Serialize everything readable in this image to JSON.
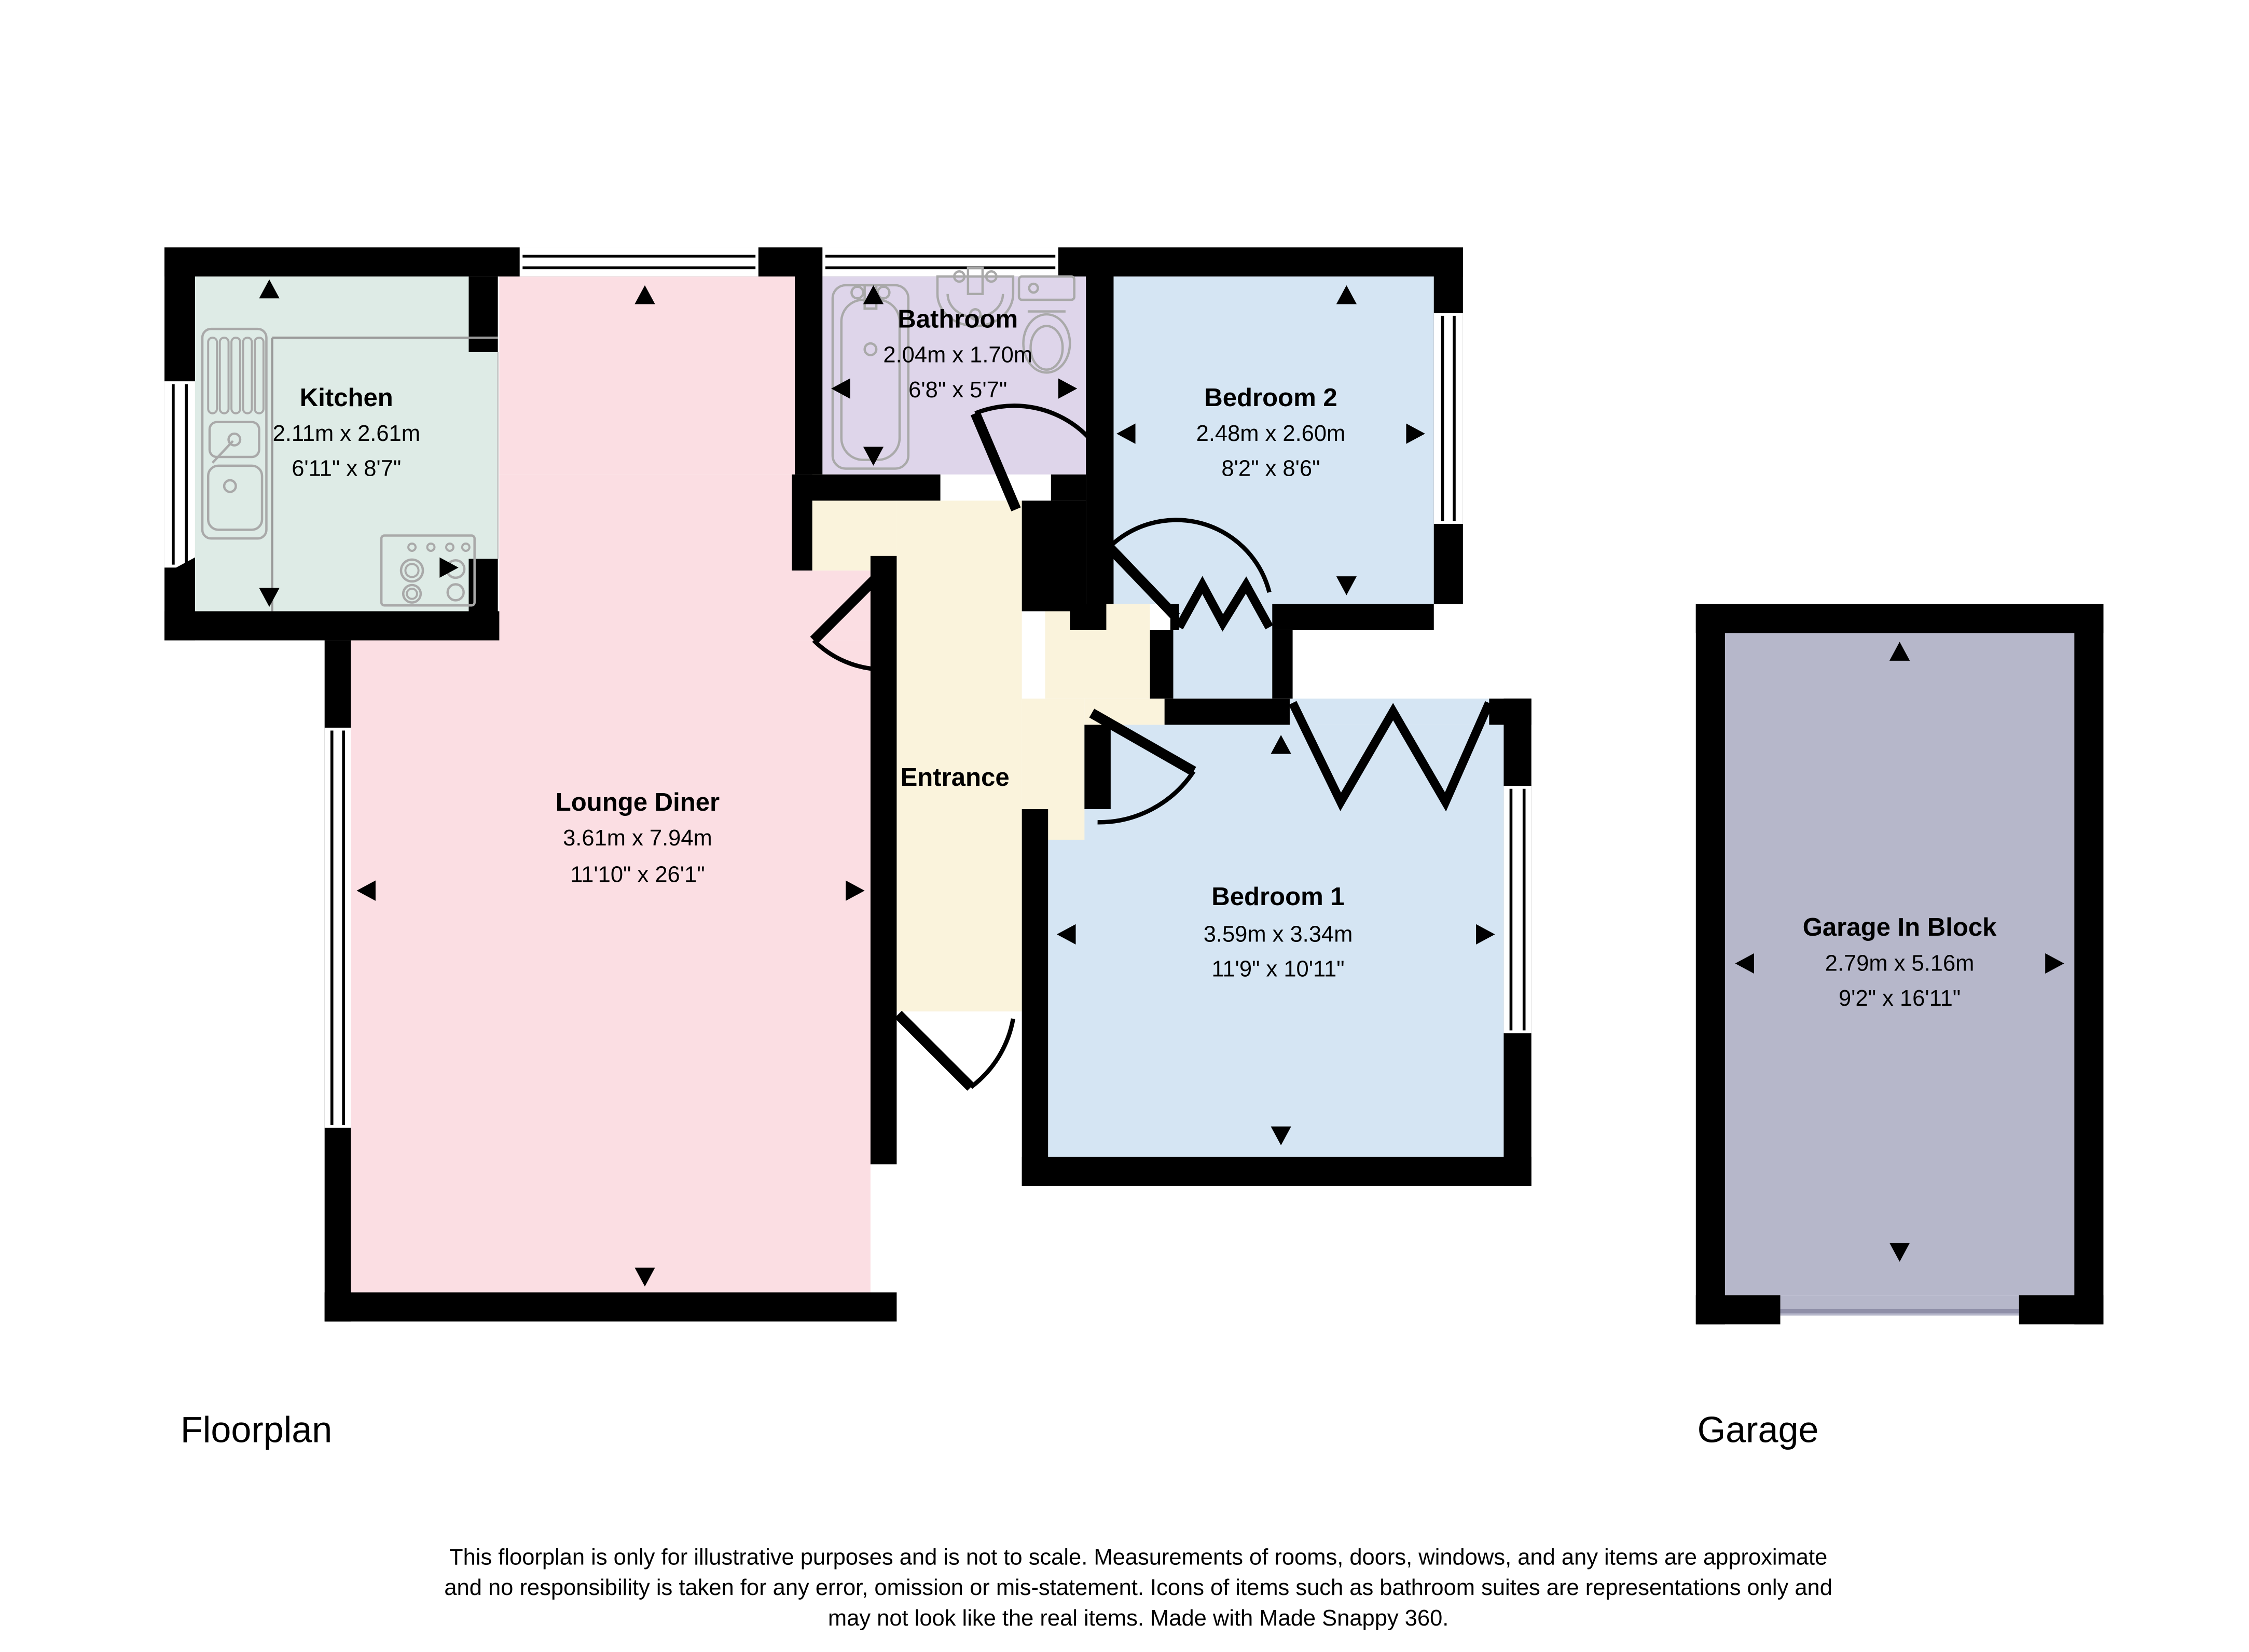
{
  "page": {
    "background": "#ffffff",
    "wall_color": "#000000"
  },
  "rooms": {
    "kitchen": {
      "name": "Kitchen",
      "metric": "2.11m x 2.61m",
      "imperial": "6'11\" x 8'7\"",
      "color": "#deebe6"
    },
    "lounge": {
      "name": "Lounge Diner",
      "metric": "3.61m x 7.94m",
      "imperial": "11'10\" x 26'1\"",
      "color": "#fbdee3"
    },
    "bathroom": {
      "name": "Bathroom",
      "metric": "2.04m x 1.70m",
      "imperial": "6'8\" x 5'7\"",
      "color": "#ded5ea"
    },
    "bedroom2": {
      "name": "Bedroom 2",
      "metric": "2.48m x 2.60m",
      "imperial": "8'2\" x 8'6\"",
      "color": "#d5e5f3"
    },
    "bedroom1": {
      "name": "Bedroom 1",
      "metric": "3.59m x 3.34m",
      "imperial": "11'9\" x 10'11\"",
      "color": "#d5e5f3"
    },
    "entrance": {
      "name": "Entrance",
      "color": "#faf3dc"
    },
    "garage": {
      "name": "Garage In Block",
      "metric": "2.79m x 5.16m",
      "imperial": "9'2\" x 16'11\"",
      "color": "#b6b7ca"
    }
  },
  "footer": {
    "floorplan_label": "Floorplan",
    "garage_label": "Garage",
    "disclaimer_line1": "This floorplan is only for illustrative purposes and is not to scale. Measurements of rooms, doors, windows, and any items are approximate",
    "disclaimer_line2": "and no responsibility is taken for any error, omission or mis-statement. Icons of items such as bathroom suites are representations only and",
    "disclaimer_line3": "may not look like the real items. Made with Made Snappy 360."
  }
}
